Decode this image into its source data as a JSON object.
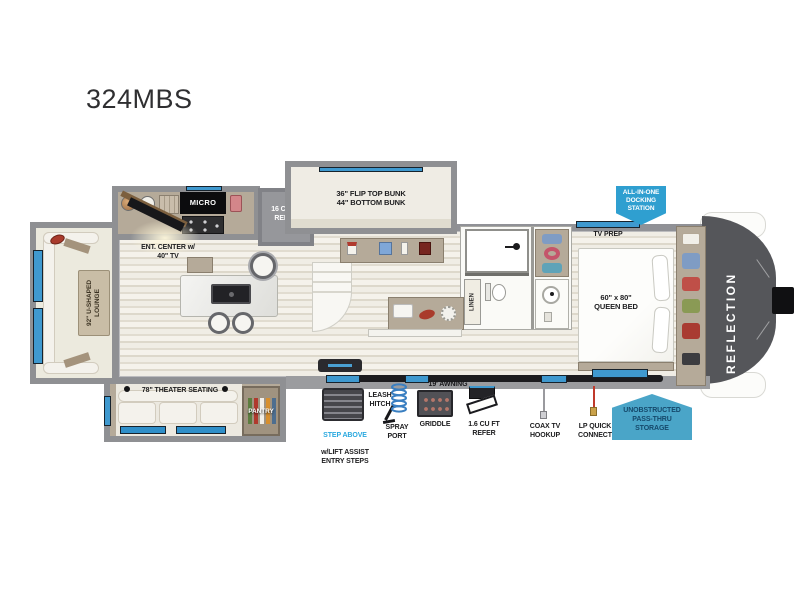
{
  "title": "324MBS",
  "colors": {
    "callout_blue": "#2f9fd0",
    "storage_blue": "#4aa5c8",
    "storage_text": "#15496b",
    "accent_text_blue": "#29a8df",
    "window_blue": "#3f99cf",
    "front_cap_gray": "#55565a",
    "wall_gray": "#8f9093"
  },
  "plan": {
    "brand": "REFLECTION",
    "kitchen": {
      "micro": "MICRO",
      "refer": "16 CU FT\nREFER",
      "ent_center": "ENT. CENTER w/\n40\" TV"
    },
    "bunk": {
      "label": "36\" FLIP TOP BUNK\n44\" BOTTOM BUNK"
    },
    "bedroom": {
      "tv_prep": "TV PREP",
      "queen": "60\" x 80\"\nQUEEN BED"
    },
    "living": {
      "lounge": "92\" U-SHAPED\nLOUNGE",
      "theater": "78\" THEATER SEATING",
      "pantry": "PANTRY"
    },
    "bath": {
      "linen": "LINEN"
    },
    "callouts": {
      "docking": "ALL-IN-ONE\nDOCKING\nSTATION",
      "pass_thru": "UNOBSTRUCTED\nPASS-THRU\nSTORAGE"
    },
    "exterior": {
      "awning": "19' AWNING",
      "step_above": "STEP ABOVE",
      "step_above_sub": "w/LIFT ASSIST\nENTRY STEPS",
      "leash": "LEASH\nHITCH",
      "spray": "SPRAY\nPORT",
      "griddle": "GRIDDLE",
      "mini_refer": "1.6 CU FT\nREFER",
      "coax": "COAX TV\nHOOKUP",
      "lp": "LP QUICK\nCONNECT"
    }
  }
}
